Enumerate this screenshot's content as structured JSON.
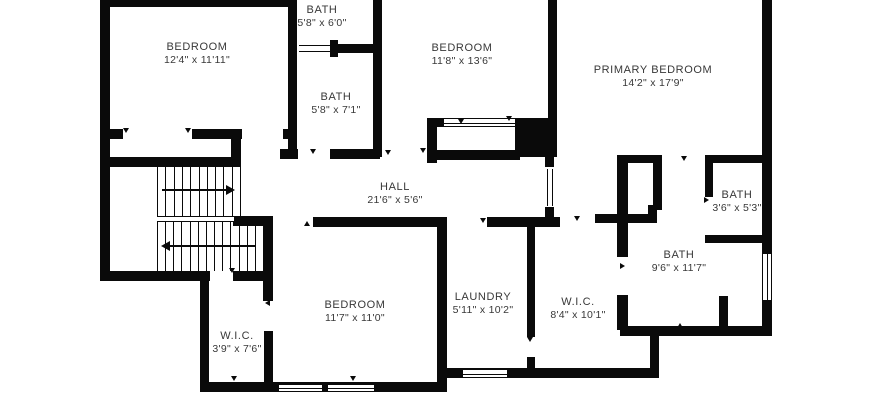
{
  "plan": {
    "canvas": {
      "width": 870,
      "height": 420,
      "background": "#ffffff",
      "wall_color": "#0a0a0a",
      "text_color": "#383838"
    },
    "rooms": [
      {
        "name": "BEDROOM",
        "dims": "12'4\" x 11'11\"",
        "cx": 197,
        "cy": 54
      },
      {
        "name": "BATH",
        "dims": "5'8\" x 6'0\"",
        "cx": 322,
        "cy": 17
      },
      {
        "name": "BATH",
        "dims": "5'8\" x 7'1\"",
        "cx": 336,
        "cy": 104
      },
      {
        "name": "BEDROOM",
        "dims": "11'8\" x 13'6\"",
        "cx": 462,
        "cy": 55
      },
      {
        "name": "PRIMARY BEDROOM",
        "dims": "14'2\" x 17'9\"",
        "cx": 653,
        "cy": 77
      },
      {
        "name": "HALL",
        "dims": "21'6\" x 5'6\"",
        "cx": 395,
        "cy": 194
      },
      {
        "name": "BATH",
        "dims": "3'6\" x 5'3\"",
        "cx": 737,
        "cy": 202
      },
      {
        "name": "BATH",
        "dims": "9'6\" x 11'7\"",
        "cx": 679,
        "cy": 262
      },
      {
        "name": "BEDROOM",
        "dims": "11'7\" x 11'0\"",
        "cx": 355,
        "cy": 312
      },
      {
        "name": "LAUNDRY",
        "dims": "5'11\" x 10'2\"",
        "cx": 483,
        "cy": 304
      },
      {
        "name": "W.I.C.",
        "dims": "8'4\" x 10'1\"",
        "cx": 578,
        "cy": 309
      },
      {
        "name": "W.I.C.",
        "dims": "3'9\" x 7'6\"",
        "cx": 237,
        "cy": 343
      }
    ],
    "walls": [
      [
        100,
        0,
        10,
        281
      ],
      [
        100,
        0,
        197,
        7
      ],
      [
        288,
        0,
        9,
        157
      ],
      [
        373,
        0,
        9,
        157
      ],
      [
        330,
        40,
        8,
        17
      ],
      [
        332,
        44,
        41,
        9
      ],
      [
        280,
        149,
        18,
        10
      ],
      [
        283,
        129,
        14,
        10
      ],
      [
        330,
        149,
        50,
        10
      ],
      [
        100,
        129,
        23,
        10
      ],
      [
        192,
        129,
        50,
        10
      ],
      [
        231,
        129,
        10,
        38
      ],
      [
        103,
        157,
        138,
        10
      ],
      [
        100,
        271,
        110,
        10
      ],
      [
        200,
        271,
        9,
        111
      ],
      [
        233,
        271,
        35,
        10
      ],
      [
        263,
        217,
        10,
        84
      ],
      [
        233,
        216,
        40,
        10
      ],
      [
        264,
        331,
        9,
        61
      ],
      [
        200,
        382,
        247,
        10
      ],
      [
        437,
        368,
        222,
        10
      ],
      [
        437,
        368,
        10,
        24
      ],
      [
        650,
        330,
        9,
        48
      ],
      [
        620,
        326,
        152,
        10
      ],
      [
        437,
        217,
        10,
        156
      ],
      [
        527,
        217,
        8,
        120
      ],
      [
        527,
        357,
        8,
        16
      ],
      [
        313,
        217,
        125,
        10
      ],
      [
        487,
        217,
        73,
        10
      ],
      [
        595,
        214,
        62,
        9
      ],
      [
        648,
        205,
        9,
        18
      ],
      [
        617,
        155,
        11,
        102
      ],
      [
        617,
        295,
        11,
        35
      ],
      [
        617,
        155,
        45,
        8
      ],
      [
        653,
        155,
        9,
        55
      ],
      [
        548,
        0,
        9,
        122
      ],
      [
        427,
        118,
        17,
        9
      ],
      [
        427,
        118,
        10,
        45
      ],
      [
        427,
        150,
        93,
        10
      ],
      [
        545,
        157,
        9,
        10
      ],
      [
        545,
        207,
        9,
        20
      ],
      [
        705,
        155,
        57,
        8
      ],
      [
        705,
        155,
        8,
        42
      ],
      [
        705,
        235,
        60,
        8
      ],
      [
        762,
        0,
        10,
        254
      ],
      [
        762,
        300,
        10,
        36
      ],
      [
        719,
        296,
        9,
        34
      ]
    ],
    "blocks": [
      [
        515,
        118,
        42,
        39
      ]
    ],
    "windows": [
      [
        443,
        118,
        73,
        9,
        "h"
      ],
      [
        462,
        369,
        46,
        9,
        "h"
      ],
      [
        278,
        384,
        45,
        8,
        "h"
      ],
      [
        327,
        384,
        48,
        8,
        "h"
      ],
      [
        762,
        253,
        10,
        48,
        "v"
      ]
    ],
    "door_leaves": [
      [
        299,
        45,
        31,
        7,
        "h"
      ],
      [
        547,
        169,
        6,
        37,
        "v"
      ],
      [
        157,
        216,
        77,
        6,
        "h"
      ]
    ],
    "door_ticks": [
      [
        126,
        131,
        "down"
      ],
      [
        188,
        131,
        "down"
      ],
      [
        313,
        152,
        "down"
      ],
      [
        348,
        221,
        "down"
      ],
      [
        307,
        224,
        "up"
      ],
      [
        388,
        153,
        "down"
      ],
      [
        423,
        151,
        "down"
      ],
      [
        461,
        122,
        "down"
      ],
      [
        509,
        119,
        "down"
      ],
      [
        483,
        221,
        "down"
      ],
      [
        577,
        219,
        "down"
      ],
      [
        623,
        266,
        "right"
      ],
      [
        680,
        326,
        "up"
      ],
      [
        684,
        159,
        "down"
      ],
      [
        707,
        200,
        "right"
      ],
      [
        232,
        271,
        "down"
      ],
      [
        268,
        303,
        "left"
      ],
      [
        353,
        379,
        "down"
      ],
      [
        234,
        379,
        "down"
      ],
      [
        530,
        340,
        "down"
      ]
    ],
    "stairs": {
      "flights": [
        {
          "x0": 157,
          "x1": 240,
          "y0": 167,
          "y1": 216,
          "n": 11
        },
        {
          "x0": 157,
          "x1": 263,
          "y0": 222,
          "y1": 271,
          "n": 14
        }
      ],
      "arrows": [
        {
          "x": 162,
          "y": 189,
          "len": 64,
          "dir": "right"
        },
        {
          "x": 170,
          "y": 245,
          "len": 86,
          "dir": "left"
        }
      ]
    }
  }
}
